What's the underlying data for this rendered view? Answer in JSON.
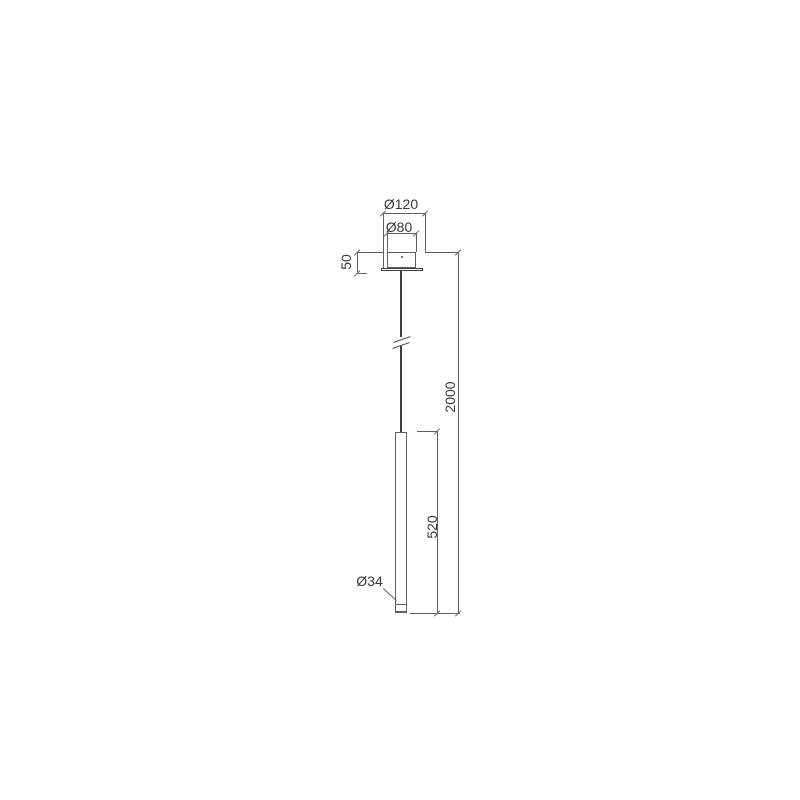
{
  "drawing": {
    "dimensions": {
      "canopy_diameter": "Ø120",
      "canopy_inner_diameter": "Ø80",
      "canopy_height": "50",
      "suspension_total": "2000",
      "tube_length": "520",
      "tube_diameter": "Ø34"
    },
    "colors": {
      "line": "#606060",
      "dark": "#3e3e3e",
      "text": "#383838",
      "background": "#ffffff"
    }
  }
}
